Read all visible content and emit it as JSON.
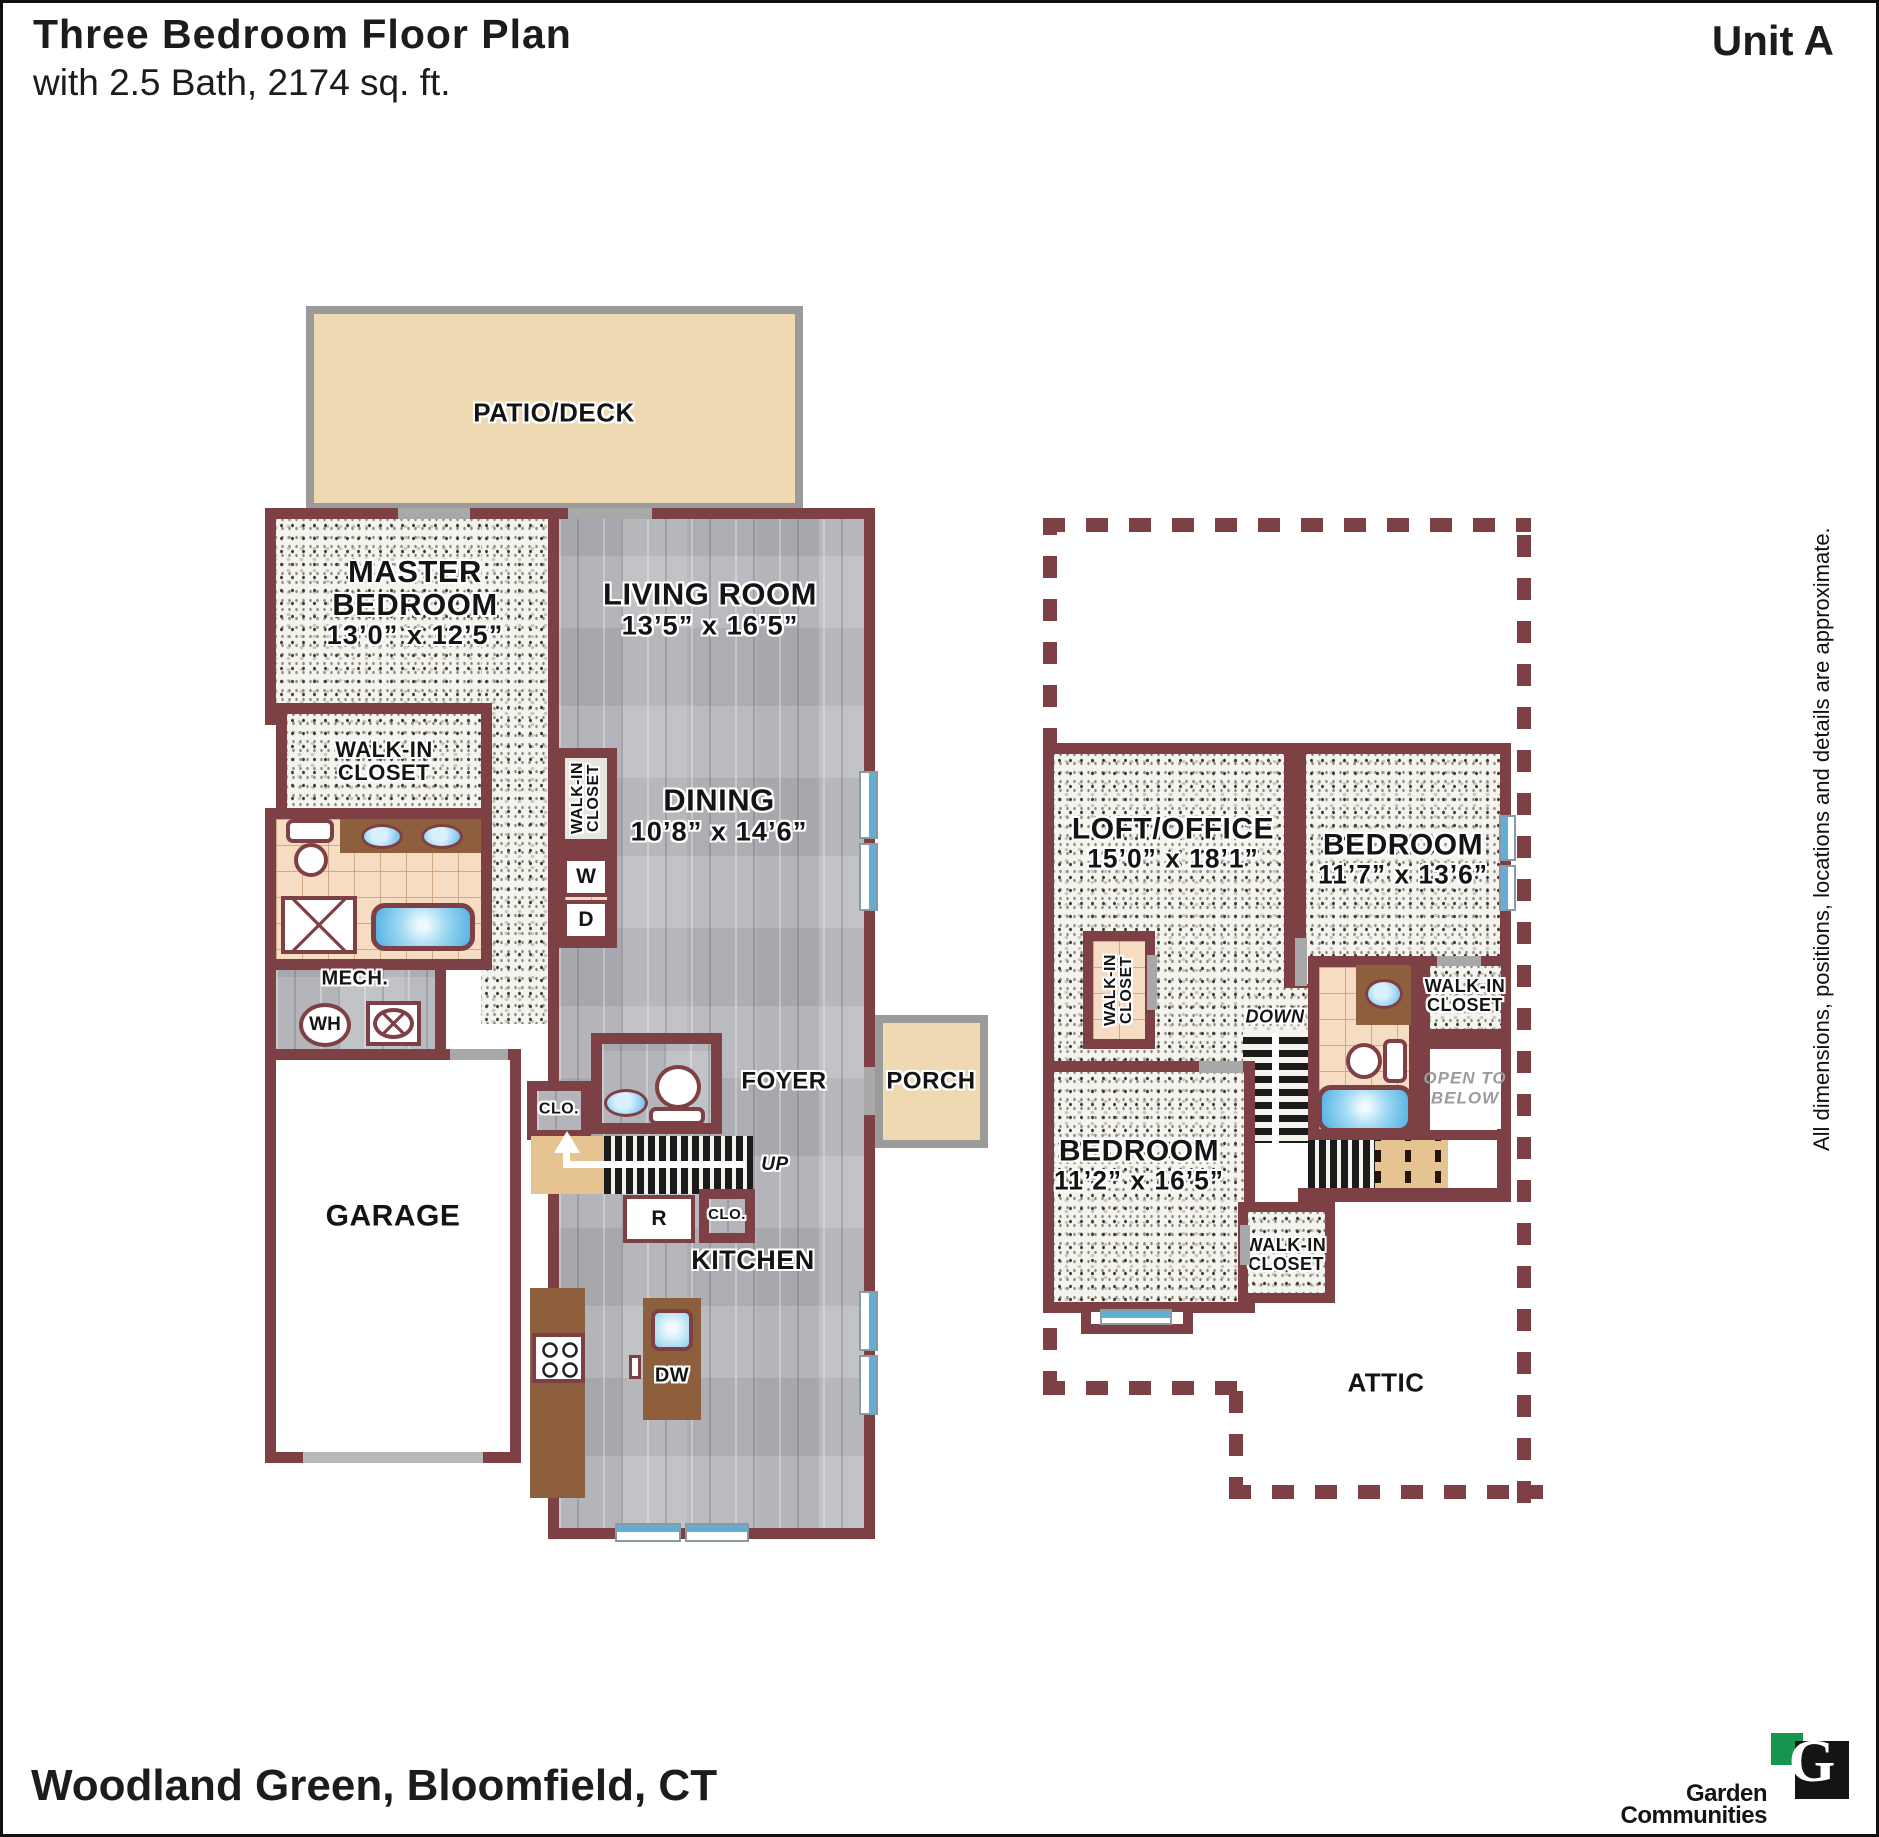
{
  "header": {
    "title": "Three Bedroom Floor Plan",
    "subtitle": "with 2.5 Bath, 2174 sq. ft.",
    "unit": "Unit A"
  },
  "disclaimer": "All dimensions, positions, locations and details are approximate.",
  "footer": {
    "location": "Woodland Green, Bloomfield, CT",
    "brand_g": "G",
    "brand_line1": "Garden",
    "brand_line2": "Communities"
  },
  "labels": {
    "patio": "PATIO/DECK",
    "porch": "PORCH",
    "garage": "GARAGE",
    "foyer": "FOYER",
    "kitchen": "KITCHEN",
    "mech": "MECH.",
    "wh": "WH",
    "clo": "CLO.",
    "up": "UP",
    "down": "DOWN",
    "washer": "W",
    "dryer": "D",
    "range": "R",
    "dishwasher": "DW",
    "attic": "ATTIC",
    "walk_in_line1": "WALK-IN",
    "walk_in_line2": "CLOSET",
    "open_below_line1": "OPEN TO",
    "open_below_line2": "BELOW",
    "master_line1": "MASTER",
    "master_line2": "BEDROOM",
    "master_dims": "13’0” x 12’5”",
    "living_name": "LIVING ROOM",
    "living_dims": "13’5” x 16’5”",
    "dining_name": "DINING",
    "dining_dims": "10’8” x 14’6”",
    "loft_name": "LOFT/OFFICE",
    "loft_dims": "15’0” x 18’1”",
    "bed2_name": "BEDROOM",
    "bed2_dims": "11’7” x 13’6”",
    "bed3_name": "BEDROOM",
    "bed3_dims": "11’2” x 16’5”"
  },
  "colors": {
    "wall": "#7d4145",
    "patio_tan": "#eed9b2",
    "tile": "#f6dcc3",
    "cabinet_brown": "#8d5f3d",
    "water_blue": "#62aed4",
    "logo_green": "#16954e"
  }
}
